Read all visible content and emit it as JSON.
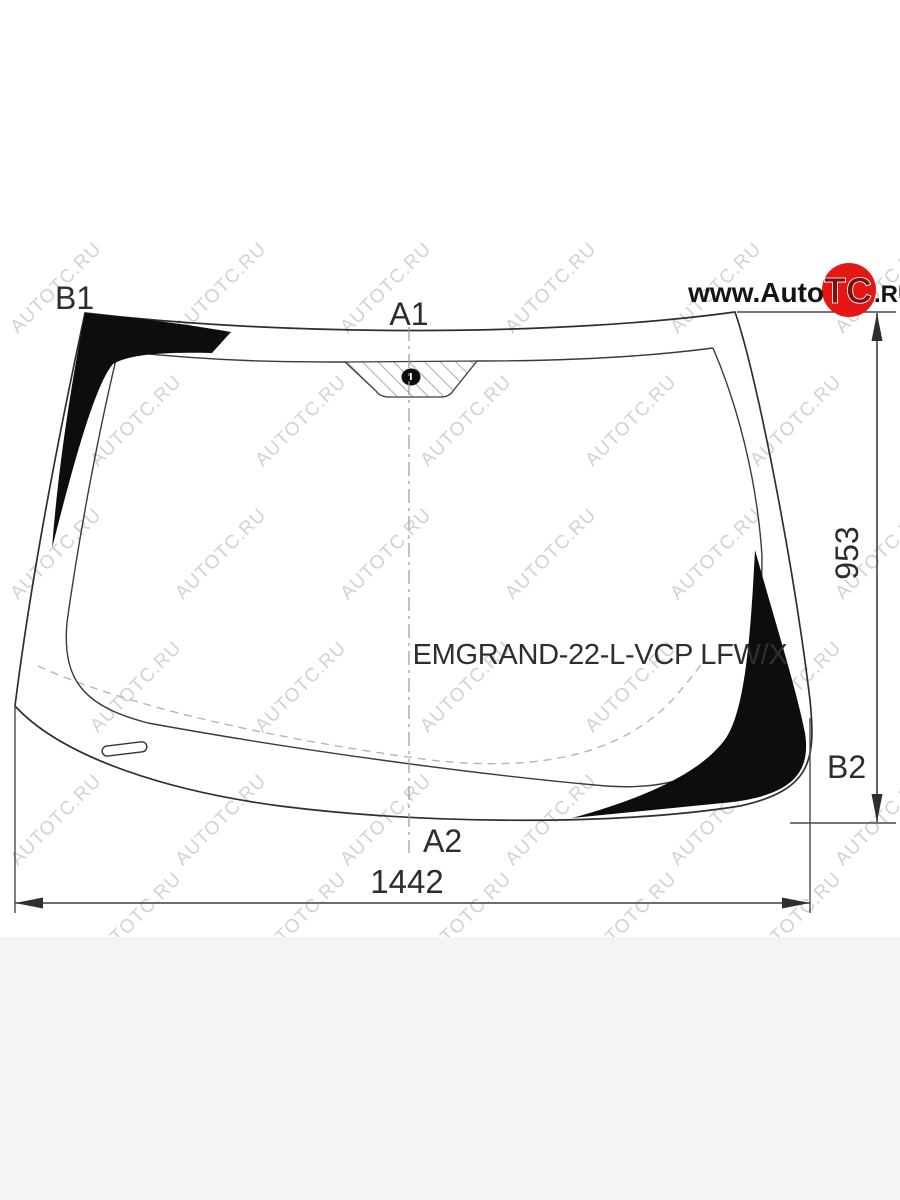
{
  "diagram": {
    "part_code": "EMGRAND-22-L-VCP LFW/X",
    "labels": {
      "top_left": "B1",
      "top_center": "A1",
      "bottom_center": "A2",
      "right_bottom": "B2"
    },
    "dimensions": {
      "height_mm": "953",
      "width_mm": "1442"
    }
  },
  "watermark": {
    "text": "AUTOTC.RU",
    "color": "#d2d2d2"
  },
  "logo": {
    "prefix": "www.Auto",
    "emblem": "TC",
    "suffix": ".RU",
    "circle_color": "#e41717"
  },
  "colors": {
    "outline": "#2f2f2f",
    "tint_black": "#0d0d0d",
    "dimension_line": "#4a4a4a",
    "footer_strip": "#f4f4f4"
  }
}
